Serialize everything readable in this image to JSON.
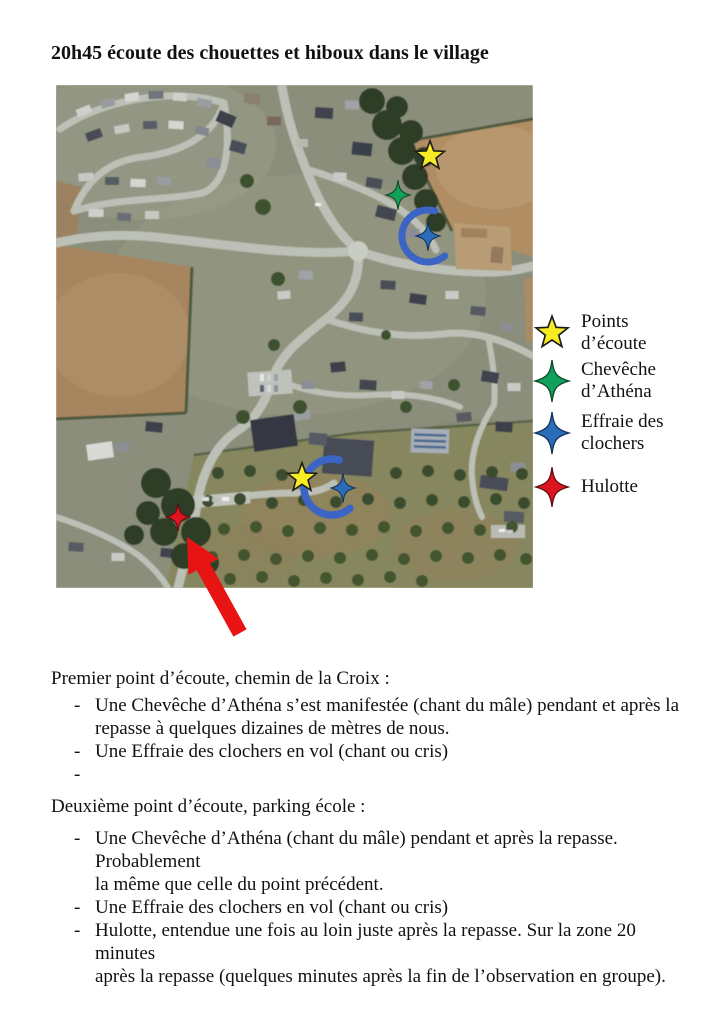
{
  "title": "20h45 écoute des chouettes et hiboux dans le village",
  "colors": {
    "points_ecoute": "#f8ec25",
    "cheveche": "#12a05a",
    "effraie": "#2a6cb8",
    "hulotte": "#dc1420",
    "arc": "#3b64c4",
    "arrow": "#e81414",
    "star_outline": "#1c1c1c"
  },
  "legend": {
    "items": [
      {
        "id": "points-ecoute",
        "shape": "star5",
        "color": "#f8ec25",
        "label": "Points\nd’écoute"
      },
      {
        "id": "cheveche-athena",
        "shape": "star4",
        "color": "#12a05a",
        "label": "Chevêche\nd’Athéna"
      },
      {
        "id": "effraie-clochers",
        "shape": "star4",
        "color": "#2a6cb8",
        "label": "Effraie des\nclochers"
      },
      {
        "id": "hulotte",
        "shape": "star4",
        "color": "#dc1420",
        "label": "Hulotte"
      }
    ]
  },
  "map": {
    "markers": [
      {
        "id": "point-ecoute-nord",
        "type": "point-ecoute",
        "shape": "star5"
      },
      {
        "id": "cheveche-nord",
        "type": "cheveche-athena",
        "shape": "star4"
      },
      {
        "id": "effraie-nord",
        "type": "effraie-clochers",
        "shape": "star4"
      },
      {
        "id": "vol-nord",
        "type": "trajectoire-vol",
        "shape": "arc"
      },
      {
        "id": "point-ecoute-sud",
        "type": "point-ecoute",
        "shape": "star5"
      },
      {
        "id": "effraie-sud",
        "type": "effraie-clochers",
        "shape": "star4"
      },
      {
        "id": "vol-sud",
        "type": "trajectoire-vol",
        "shape": "arc"
      },
      {
        "id": "hulotte-sud",
        "type": "hulotte",
        "shape": "star4"
      },
      {
        "id": "fleche-rouge",
        "type": "fleche",
        "shape": "arrow"
      }
    ]
  },
  "bullet_marker": "-",
  "sections": [
    {
      "heading": "Premier point d’écoute, chemin de la Croix :",
      "bullets": [
        "Une Chevêche d’Athéna s’est manifestée (chant du mâle) pendant et après la\nrepasse à quelques dizaines de mètres de nous.",
        "Une Effraie des clochers en vol (chant ou cris)",
        ""
      ]
    },
    {
      "heading": "Deuxième point d’écoute, parking école :",
      "bullets": [
        "Une Chevêche d’Athéna (chant du mâle) pendant et après la repasse. Probablement\nla même que celle du point précédent.",
        "Une Effraie des clochers en vol (chant ou cris)",
        "Hulotte, entendue une fois au loin juste après la repasse. Sur la zone 20 minutes\naprès la repasse (quelques minutes après la fin de l’observation en groupe)."
      ]
    }
  ]
}
